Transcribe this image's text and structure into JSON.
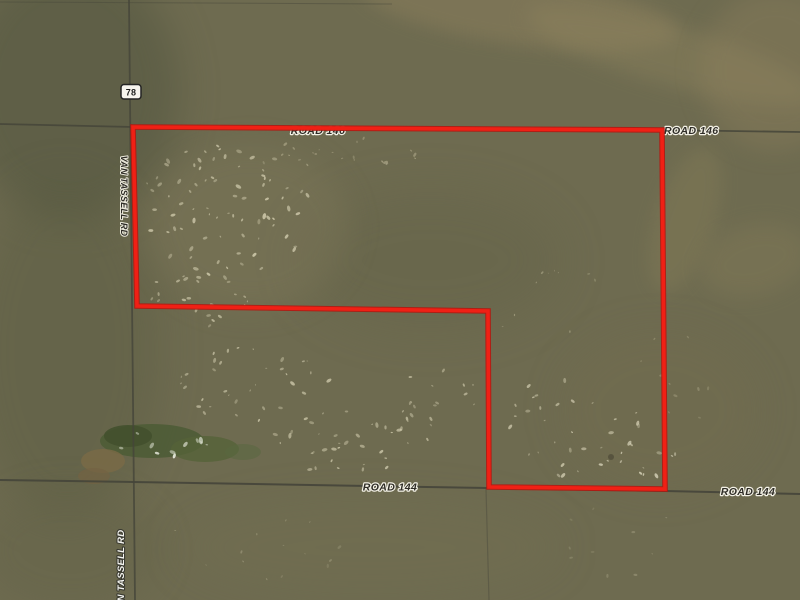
{
  "map": {
    "kind": "satellite-aerial-map",
    "terrain_base_color": "#6e6b50",
    "parcel": {
      "outline_color": "#e81c12",
      "points": "133,127 662,130 665,489 489,487 488,311 137,306"
    },
    "roads": {
      "road146": {
        "label_center": "ROAD 146",
        "label_right": "ROAD 146",
        "points": "0,124 133,127 662,130 800,132"
      },
      "road144": {
        "label_center": "ROAD 144",
        "label_right": "ROAD 144",
        "points": "0,480 133,482 488,488 665,491 800,494"
      },
      "van_tassell": {
        "label_top": "VAN TASSELL RD",
        "label_bottom": "VAN TASSELL RD",
        "points": "129,0 132,300 135,600"
      },
      "field_line_top": {
        "points": "0,2 392,4"
      },
      "trail_south": {
        "points": "486,489 489,600"
      }
    },
    "highway_shield": {
      "number": "78"
    }
  }
}
